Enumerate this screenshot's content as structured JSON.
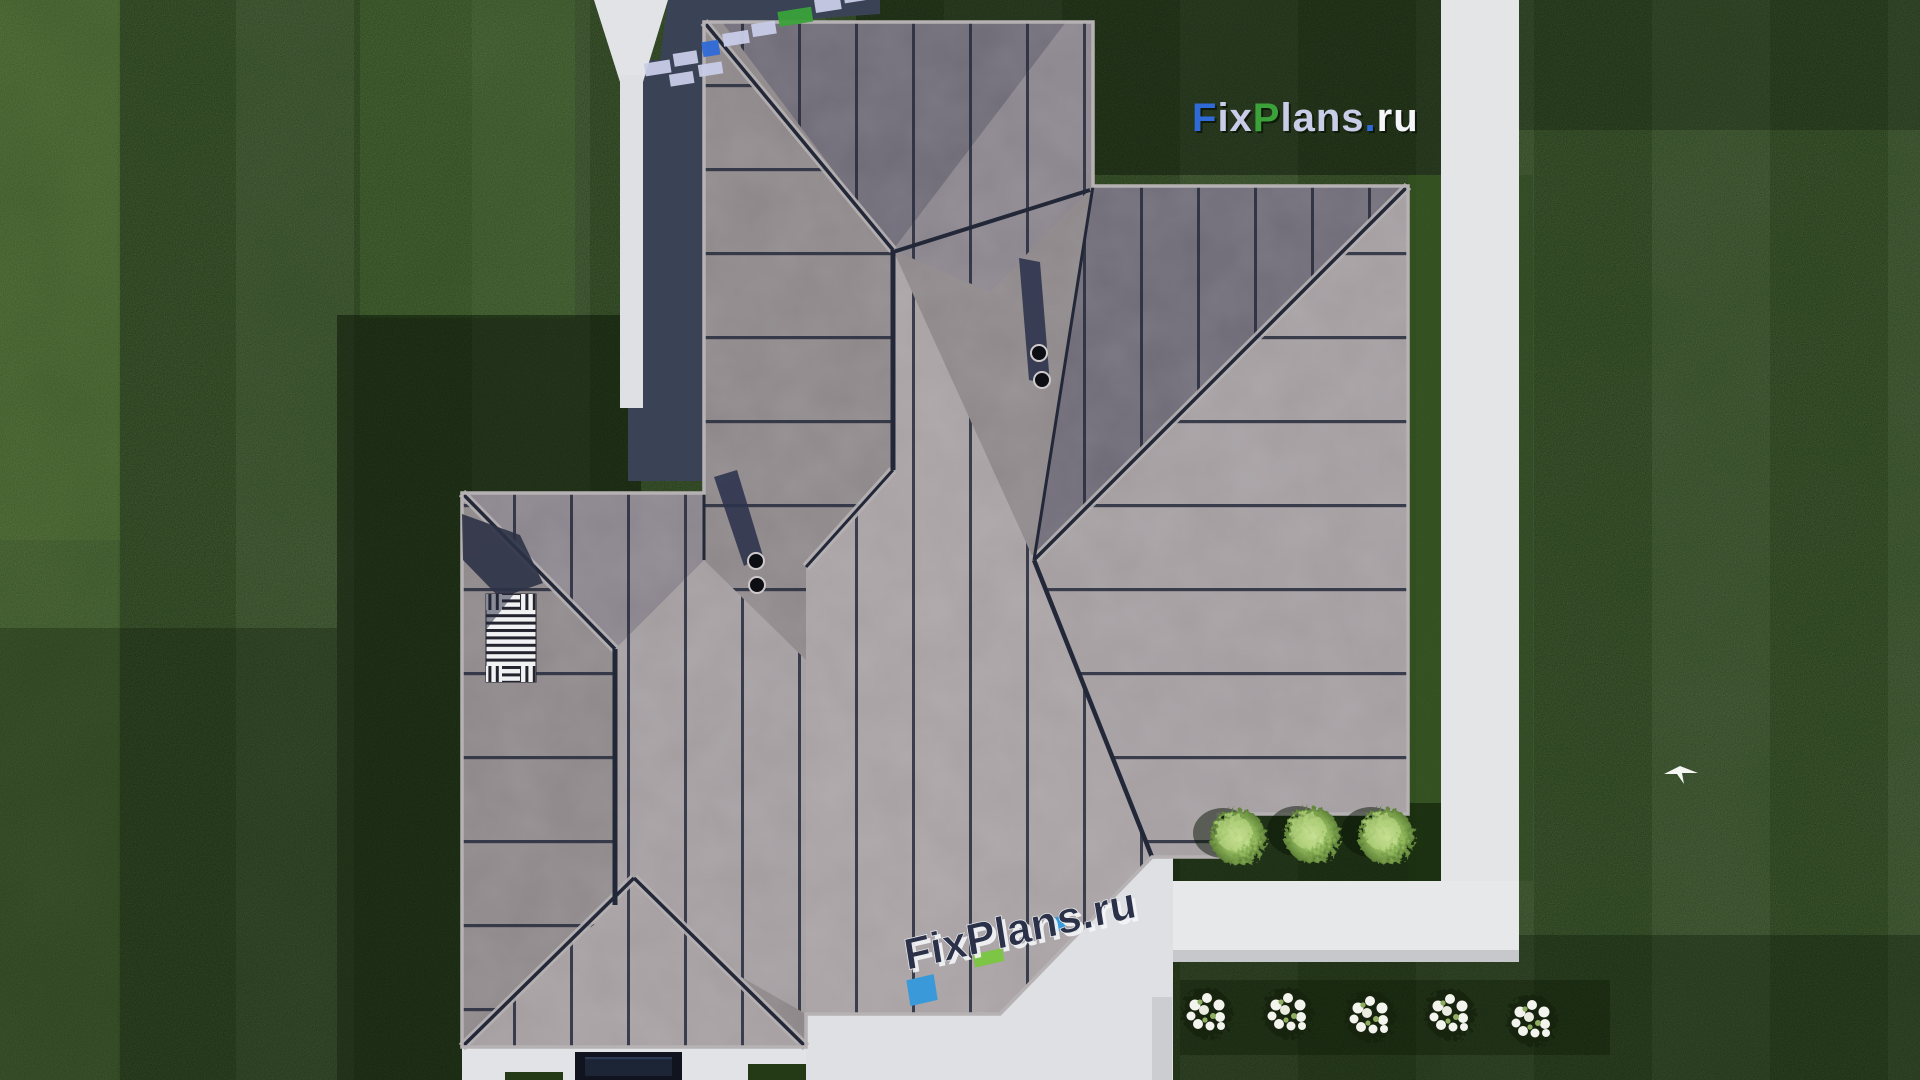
{
  "scene": {
    "title": "Aerial top-down 3D render of hip-roof house with lawn and paths",
    "width_px": 1920,
    "height_px": 1080
  },
  "watermarks": {
    "top_right": {
      "f": "F",
      "ix": "ix",
      "p": "P",
      "lans": "lans",
      "dot": ".",
      "ru": "ru"
    },
    "bottom_center": {
      "text": "FixPlans.ru"
    },
    "colors": {
      "blue": "#2f6bd8",
      "green": "#3ba23a",
      "lavender": "#c9cde8",
      "white": "#f5f6fa",
      "embedded_navy": "#2a3148",
      "embedded_blue": "#3a9ad9",
      "embedded_green": "#7dc544"
    }
  },
  "roof": {
    "base_color": "#8d8789",
    "dark_plane_color": "#6e6a76",
    "light_plane_color": "#a8a1a4",
    "seam_color": "#262b3c",
    "trim_color": "#b6b1b3",
    "chimney_stacks": 2,
    "pipes_per_stack": 2,
    "trellis_panels": 1
  },
  "ground": {
    "lawn_color": "#203418",
    "lawn_stripe_light": "#41602a",
    "path_color": "#e4e5e7",
    "paving_shadow_color": "#3a4256",
    "green_bushes": 3,
    "white_flower_clusters": 5,
    "birds": 1
  }
}
